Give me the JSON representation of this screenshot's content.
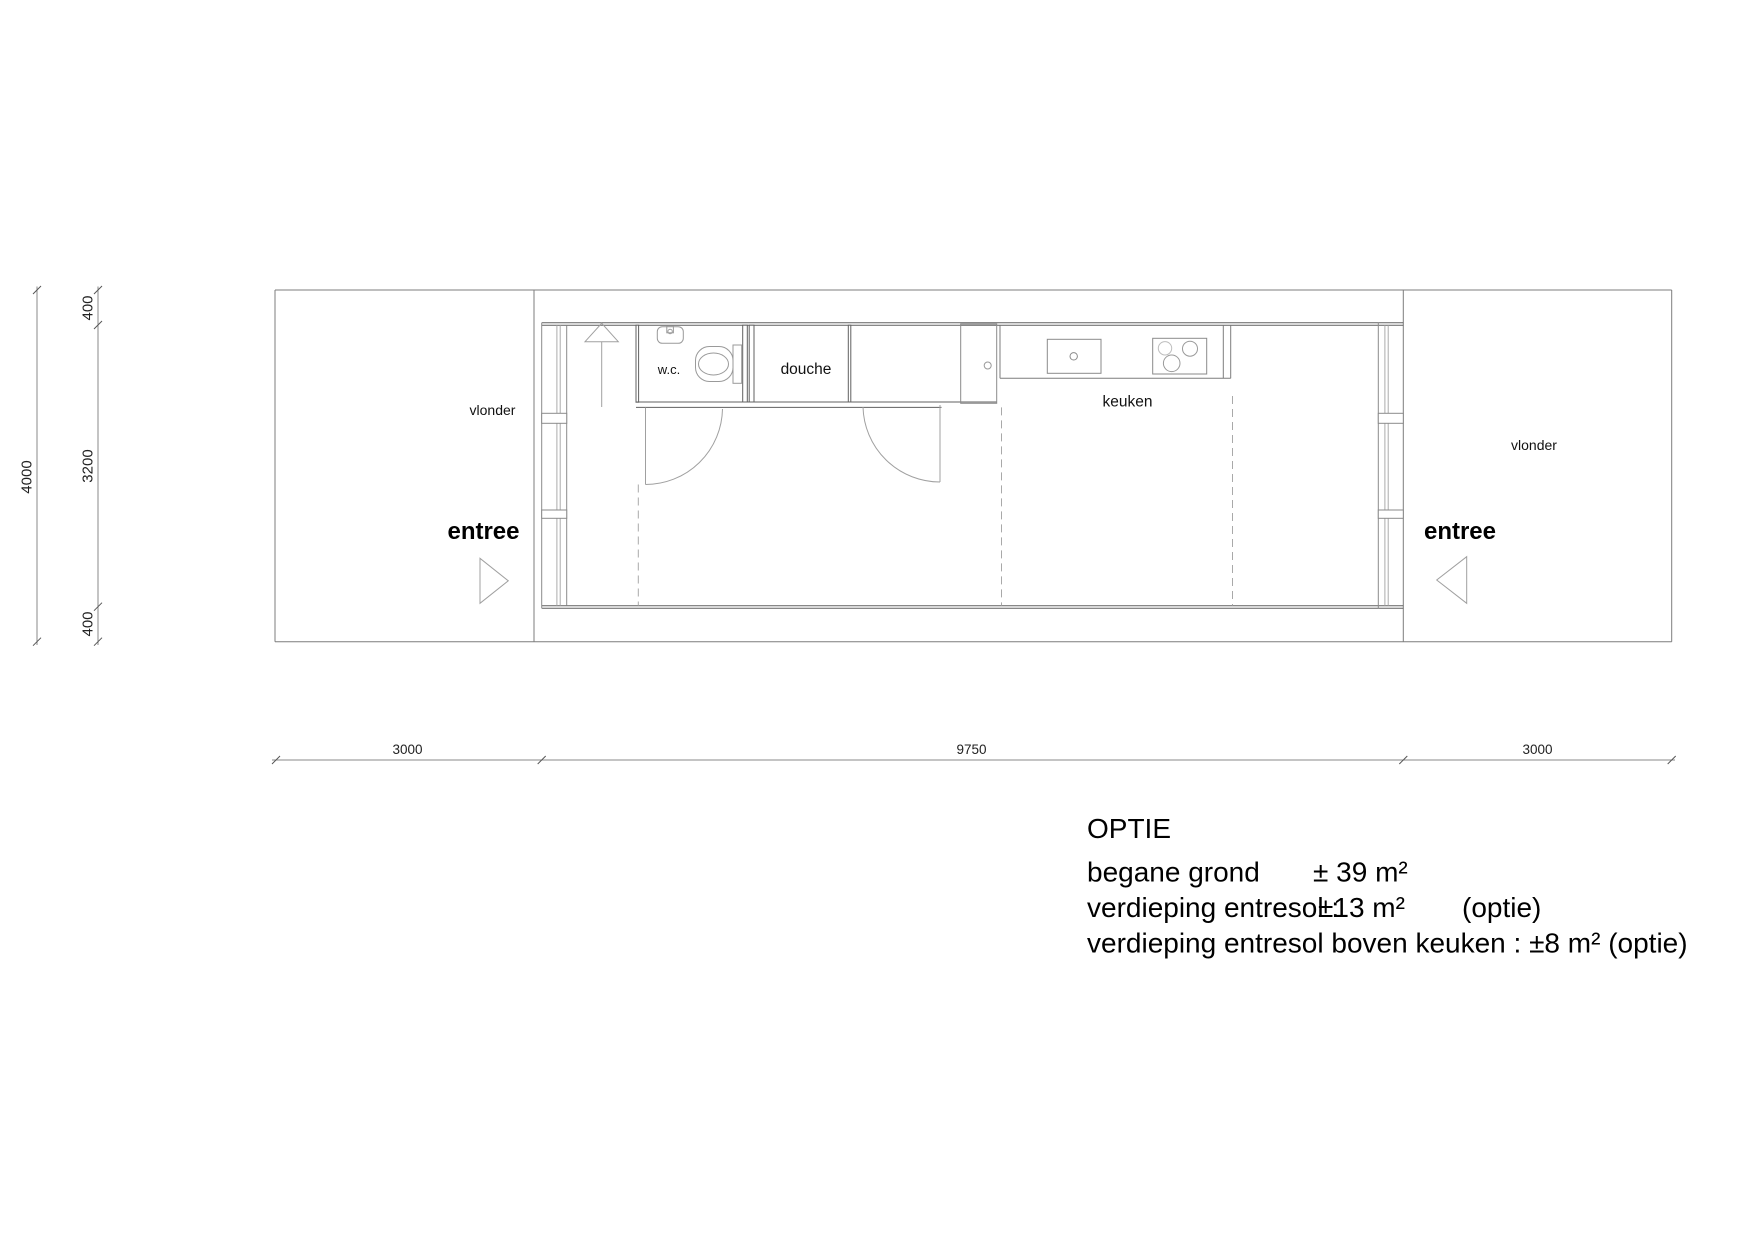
{
  "drawing_type": "architectural floor plan",
  "colors": {
    "background": "#ffffff",
    "outline": "#7d7d7d",
    "wall": "#606060",
    "fixture": "#9a9a9a",
    "glazing": "#ababab",
    "dashed_overhead": "#a9a9a9",
    "text": "#000000"
  },
  "plan": {
    "rooms": {
      "wc": "w.c.",
      "douche": "douche",
      "keuken": "keuken"
    },
    "areas": {
      "vlonder_left": "vlonder",
      "vlonder_right": "vlonder",
      "entree_left": "entree",
      "entree_right": "entree"
    }
  },
  "dimensions": {
    "vertical": {
      "total": "4000",
      "segments": [
        "400",
        "3200",
        "400"
      ]
    },
    "horizontal": {
      "segments": [
        "3000",
        "9750",
        "3000"
      ]
    }
  },
  "legend": {
    "title": "OPTIE",
    "rows": [
      {
        "label": "begane grond",
        "value": "± 39 m²",
        "note": ""
      },
      {
        "label": "verdieping entresol :",
        "value": "±13 m²",
        "note": "(optie)"
      },
      {
        "label": "verdieping entresol boven keuken : ±8 m² (optie)",
        "value": "",
        "note": ""
      }
    ]
  }
}
